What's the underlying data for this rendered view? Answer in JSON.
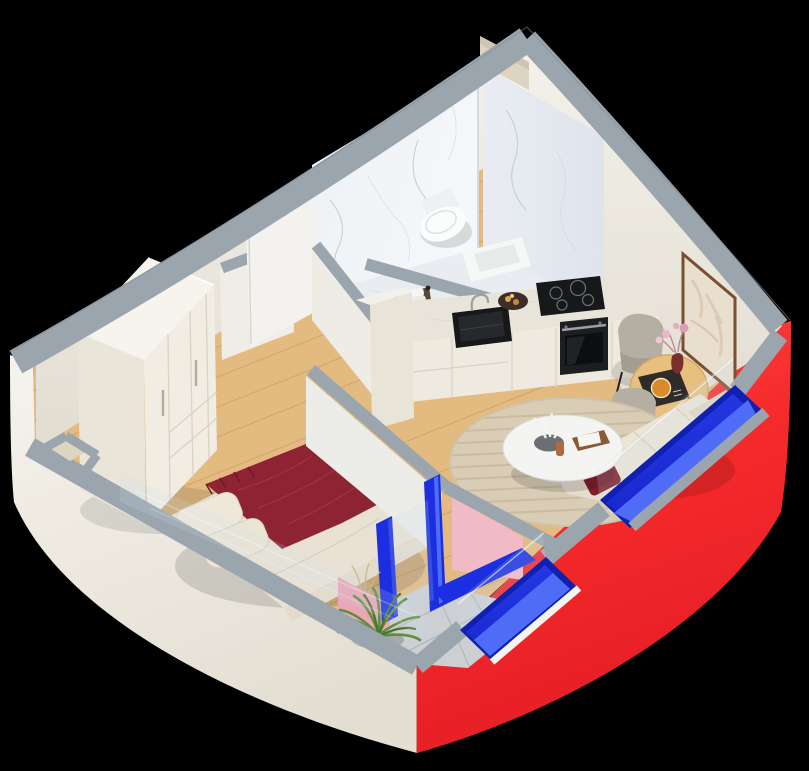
{
  "scene": {
    "title": "isometric-apartment-3d-floor-plan",
    "background": "#000000",
    "view": "axonometric cutaway from above"
  },
  "palette": {
    "gray_cap": "#9aa5ad",
    "gray_cap_dark": "#8b959d",
    "white_wall": "#f2efe8",
    "white_wall_shade": "#e6e1d6",
    "cream_wall": "#efece4",
    "red_wall": "#f62b2b",
    "red_wall_deep": "#e81f27",
    "blue_frame": "#1c2fe0",
    "blue_frame_light": "#4f6cf7",
    "blue_frame_deep": "#1020b0",
    "pink_wall": "#f2b9c7",
    "pink_wall_shade": "#e9a7b8",
    "wood_floor": "#e3bb81",
    "wood_floor_light": "#ecca93",
    "marble_wall": "#f0f2f5",
    "marble_wall_shade": "#e4e8ee",
    "marble_floor": "#e9edf1",
    "balcony_tile": "#ccd0d2",
    "cabinet_cream": "#efeadf",
    "cabinet_top_marble": "#e9e4da",
    "appliance_black": "#17181a",
    "oven_black": "#1c1e22",
    "wardrobe_cream": "#f1ede3",
    "wardrobe_top": "#f7f4ed",
    "wardrobe_side": "#eae5d9",
    "bed_duvet": "#e9e2d4",
    "bed_frame": "#e3dccc",
    "throw_red": "#8e2433",
    "pillow_red": "#7e1f2c",
    "sofa_cream": "#ece5d6",
    "sofa_shade": "#e0d8c6",
    "rug_beige": "#d9cdb6",
    "rug_stripe": "#c9bca2",
    "table_wood": "#e7c080",
    "chair_gray": "#b5aea3",
    "chair_gray_dark": "#a49d92",
    "art_frame": "#7a5130",
    "art_fill": "#e9dfcf",
    "plant_green": "#5d8f3a",
    "plant_green_dark": "#47762b",
    "vent_beige": "#ddd5c2",
    "menu_black": "#2e2b28",
    "food_orange": "#d98a2b",
    "basket_brown": "#5a4536",
    "copper": "#b06a3e",
    "door_white": "#f4f2ee"
  },
  "rooms": [
    {
      "id": "bathroom",
      "label": "bathroom",
      "floor": "marble"
    },
    {
      "id": "kitchen",
      "label": "kitchen",
      "floor": "wood"
    },
    {
      "id": "dining",
      "label": "dining-area",
      "floor": "wood"
    },
    {
      "id": "living",
      "label": "living-area",
      "floor": "wood"
    },
    {
      "id": "bedroom",
      "label": "bedroom",
      "floor": "wood"
    },
    {
      "id": "hallway",
      "label": "hallway",
      "floor": "wood"
    },
    {
      "id": "balcony",
      "label": "loggia-balcony",
      "floor": "stone-tile"
    }
  ],
  "furniture": [
    "wall-hung-toilet",
    "kitchen-counter",
    "sink",
    "induction-hob",
    "built-in-oven",
    "serving-board",
    "towel-basket",
    "wardrobe",
    "double-bed",
    "red-throw-blanket",
    "open-door",
    "dining-table",
    "dining-chairs",
    "flower-vase",
    "menu-placemat",
    "wall-art",
    "sofa",
    "red-pillow",
    "coffee-table",
    "round-rug",
    "palm-plant",
    "window-boxes"
  ]
}
